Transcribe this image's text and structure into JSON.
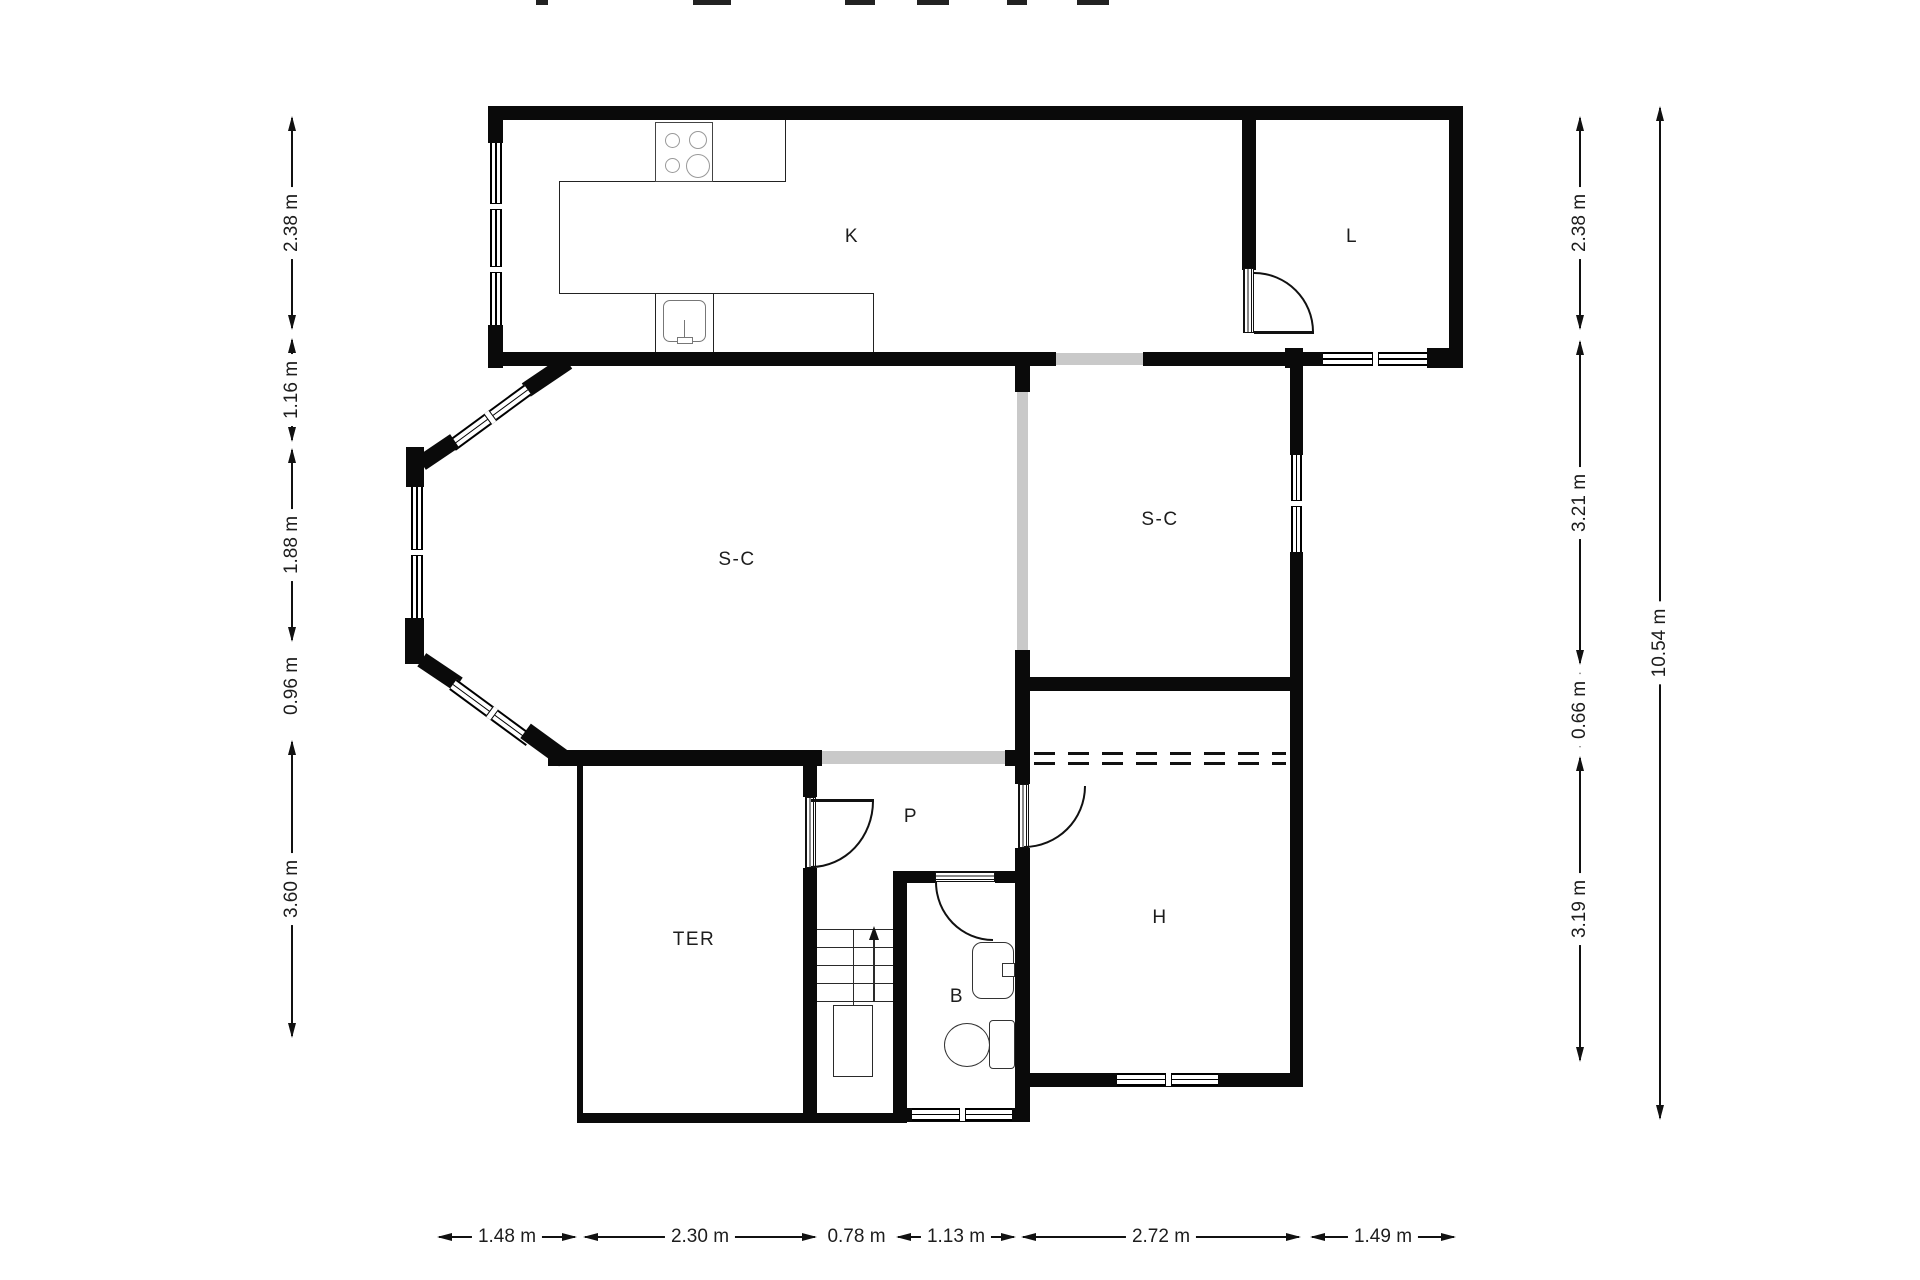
{
  "title": "apartment-floor-plan",
  "colors": {
    "wall": "#0a0a0a",
    "line": "#222222",
    "opening": "#c9c9c9",
    "text": "#1d1d1d",
    "background": "#ffffff"
  },
  "rooms": [
    {
      "id": "kitchen",
      "label": "K"
    },
    {
      "id": "laundry",
      "label": "L"
    },
    {
      "id": "living-left",
      "label": "S-C"
    },
    {
      "id": "living-right",
      "label": "S-C"
    },
    {
      "id": "hall",
      "label": "P"
    },
    {
      "id": "terrace",
      "label": "TER"
    },
    {
      "id": "bathroom",
      "label": "B"
    },
    {
      "id": "bedroom",
      "label": "H"
    }
  ],
  "dimensions": {
    "left": [
      "2.38 m",
      "1.16 m",
      "1.88 m",
      "0.96 m",
      "3.60 m"
    ],
    "right": [
      "2.38 m",
      "3.21 m",
      "0.66 m",
      "3.19 m"
    ],
    "right_total": "10.54 m",
    "bottom": [
      "1.48 m",
      "2.30 m",
      "0.78 m",
      "1.13 m",
      "2.72 m",
      "1.49 m"
    ]
  },
  "icons": {
    "stove": "4-burner-cooktop",
    "kitchen_sink": "single-basin-sink",
    "bath_sink": "washbasin",
    "toilet": "toilet-with-tank",
    "stairs": "u-shaped-stair-up"
  }
}
